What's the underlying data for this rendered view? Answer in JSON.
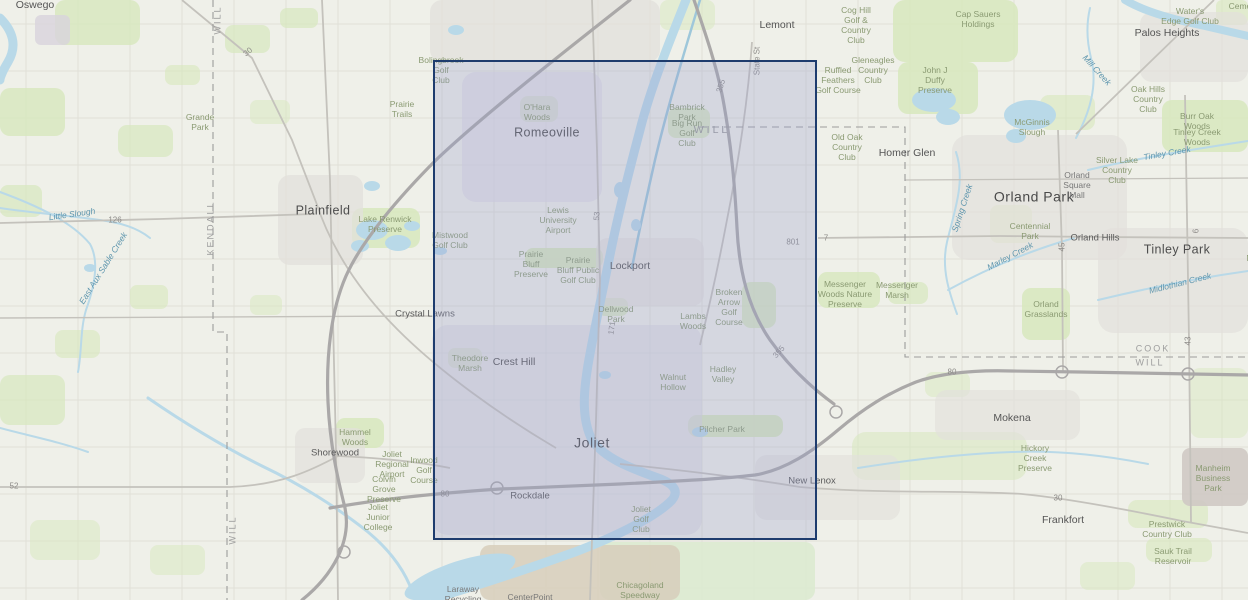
{
  "map": {
    "background": "#eff0e9",
    "selection": {
      "x": 433,
      "y": 60,
      "w": 384,
      "h": 480,
      "fill": "rgba(151,160,205,0.30)",
      "border_color": "#1e3c6e",
      "border_px": 2.5
    },
    "labels": [
      {
        "text": "Oswego",
        "x": 35,
        "y": 5,
        "cls": "town"
      },
      {
        "text": "Plainfield",
        "x": 323,
        "y": 211,
        "cls": "town-lg"
      },
      {
        "text": "Romeoville",
        "x": 547,
        "y": 133,
        "cls": "town-lg"
      },
      {
        "text": "Lemont",
        "x": 777,
        "y": 25,
        "cls": "town"
      },
      {
        "text": "Palos Heights",
        "x": 1167,
        "y": 33,
        "cls": "town"
      },
      {
        "text": "Homer Glen",
        "x": 907,
        "y": 153,
        "cls": "town"
      },
      {
        "text": "Orland Park",
        "x": 1034,
        "y": 197,
        "cls": "town-xl"
      },
      {
        "text": "Orland Hills",
        "x": 1095,
        "y": 238,
        "cls": "town-sm"
      },
      {
        "text": "Tinley Park",
        "x": 1177,
        "y": 250,
        "cls": "town-lg"
      },
      {
        "text": "Lockport",
        "x": 630,
        "y": 266,
        "cls": "town"
      },
      {
        "text": "Crystal Lawns",
        "x": 425,
        "y": 314,
        "cls": "town-sm"
      },
      {
        "text": "Crest Hill",
        "x": 514,
        "y": 362,
        "cls": "town"
      },
      {
        "text": "Joliet",
        "x": 592,
        "y": 443,
        "cls": "town-xl"
      },
      {
        "text": "Rockdale",
        "x": 530,
        "y": 496,
        "cls": "town-sm"
      },
      {
        "text": "Shorewood",
        "x": 335,
        "y": 453,
        "cls": "town-sm"
      },
      {
        "text": "New Lenox",
        "x": 812,
        "y": 481,
        "cls": "town-sm"
      },
      {
        "text": "Mokena",
        "x": 1012,
        "y": 418,
        "cls": "town"
      },
      {
        "text": "Frankfort",
        "x": 1063,
        "y": 520,
        "cls": "town"
      },
      {
        "text": "Grande\nPark",
        "x": 200,
        "y": 122,
        "cls": "area"
      },
      {
        "text": "Prairie\nTrails",
        "x": 402,
        "y": 109,
        "cls": "area"
      },
      {
        "text": "Lake Renwick\nPreserve",
        "x": 385,
        "y": 224,
        "cls": "area"
      },
      {
        "text": "Bolingbrook\nGolf\nClub",
        "x": 441,
        "y": 70,
        "cls": "area"
      },
      {
        "text": "O'Hara\nWoods",
        "x": 537,
        "y": 112,
        "cls": "area"
      },
      {
        "text": "Bambrick\nPark",
        "x": 687,
        "y": 112,
        "cls": "area"
      },
      {
        "text": "Big Run\nGolf\nClub",
        "x": 687,
        "y": 133,
        "cls": "area"
      },
      {
        "text": "Mistwood\nGolf Club",
        "x": 450,
        "y": 240,
        "cls": "area"
      },
      {
        "text": "Lewis\nUniversity\nAirport",
        "x": 558,
        "y": 220,
        "cls": "area"
      },
      {
        "text": "Prairie\nBluff\nPreserve",
        "x": 531,
        "y": 264,
        "cls": "area"
      },
      {
        "text": "Prairie\nBluff Public\nGolf Club",
        "x": 578,
        "y": 270,
        "cls": "area"
      },
      {
        "text": "Dellwood\nPark",
        "x": 616,
        "y": 314,
        "cls": "area"
      },
      {
        "text": "Lambs\nWoods",
        "x": 693,
        "y": 321,
        "cls": "area"
      },
      {
        "text": "Broken\nArrow\nGolf\nCourse",
        "x": 729,
        "y": 307,
        "cls": "area"
      },
      {
        "text": "Theodore\nMarsh",
        "x": 470,
        "y": 363,
        "cls": "area"
      },
      {
        "text": "Walnut\nHollow",
        "x": 673,
        "y": 382,
        "cls": "area"
      },
      {
        "text": "Hadley\nValley",
        "x": 723,
        "y": 374,
        "cls": "area"
      },
      {
        "text": "Pilcher Park",
        "x": 722,
        "y": 429,
        "cls": "area"
      },
      {
        "text": "Joliet\nGolf\nClub",
        "x": 641,
        "y": 519,
        "cls": "area"
      },
      {
        "text": "Hammel\nWoods",
        "x": 355,
        "y": 437,
        "cls": "area"
      },
      {
        "text": "Joliet\nRegional\nAirport",
        "x": 392,
        "y": 464,
        "cls": "area"
      },
      {
        "text": "Colvin\nGrove\nPreserve",
        "x": 384,
        "y": 489,
        "cls": "area"
      },
      {
        "text": "Inwood\nGolf\nCourse",
        "x": 424,
        "y": 470,
        "cls": "area"
      },
      {
        "text": "Joliet\nJunior\nCollege",
        "x": 378,
        "y": 517,
        "cls": "area"
      },
      {
        "text": "Cog Hill\nGolf &\nCountry\nClub",
        "x": 856,
        "y": 25,
        "cls": "area"
      },
      {
        "text": "Cap Sauers\nHoldings",
        "x": 978,
        "y": 19,
        "cls": "area"
      },
      {
        "text": "Gleneagles\nCountry\nClub",
        "x": 873,
        "y": 70,
        "cls": "area"
      },
      {
        "text": "Ruffled\nFeathers\nGolf Course",
        "x": 838,
        "y": 80,
        "cls": "area"
      },
      {
        "text": "John J\nDuffy\nPreserve",
        "x": 935,
        "y": 80,
        "cls": "area"
      },
      {
        "text": "Water's\nEdge Golf Club",
        "x": 1190,
        "y": 16,
        "cls": "area"
      },
      {
        "text": "Cemetery",
        "x": 1247,
        "y": 6,
        "cls": "area"
      },
      {
        "text": "Oak Hills\nCountry\nClub",
        "x": 1148,
        "y": 99,
        "cls": "area"
      },
      {
        "text": "Burr Oak\nWoods",
        "x": 1197,
        "y": 121,
        "cls": "area"
      },
      {
        "text": "Tinley Creek\nWoods",
        "x": 1197,
        "y": 137,
        "cls": "area"
      },
      {
        "text": "McGinnis\nSlough",
        "x": 1032,
        "y": 127,
        "cls": "area"
      },
      {
        "text": "Old Oak\nCountry\nClub",
        "x": 847,
        "y": 147,
        "cls": "area"
      },
      {
        "text": "Silver Lake\nCountry\nClub",
        "x": 1117,
        "y": 170,
        "cls": "area"
      },
      {
        "text": "Orland\nSquare\nMall",
        "x": 1077,
        "y": 185,
        "cls": "poi-gray"
      },
      {
        "text": "Centennial\nPark",
        "x": 1030,
        "y": 231,
        "cls": "area"
      },
      {
        "text": "Messenger\nWoods Nature\nPreserve",
        "x": 845,
        "y": 294,
        "cls": "area"
      },
      {
        "text": "Messenger\nMarsh",
        "x": 897,
        "y": 290,
        "cls": "area"
      },
      {
        "text": "Orland\nGrasslands",
        "x": 1046,
        "y": 309,
        "cls": "area"
      },
      {
        "text": "Hickory\nCreek\nPreserve",
        "x": 1035,
        "y": 458,
        "cls": "area"
      },
      {
        "text": "Manheim\nBusiness\nPark",
        "x": 1213,
        "y": 478,
        "cls": "area"
      },
      {
        "text": "Prestwick\nCountry Club",
        "x": 1167,
        "y": 529,
        "cls": "area"
      },
      {
        "text": "Sauk Trail\nReservoir",
        "x": 1173,
        "y": 556,
        "cls": "area"
      },
      {
        "text": "Chicagoland\nSpeedway",
        "x": 640,
        "y": 590,
        "cls": "area"
      },
      {
        "text": "CenterPoint",
        "x": 530,
        "y": 597,
        "cls": "poi-gray"
      },
      {
        "text": "Laraway\nRecycling",
        "x": 463,
        "y": 594,
        "cls": "poi-gray"
      },
      {
        "text": "George W Dunne\nNational",
        "x": 1262,
        "y": 243,
        "cls": "area"
      },
      {
        "text": "Little Slough",
        "x": 72,
        "y": 214,
        "cls": "water",
        "rot": -8
      },
      {
        "text": "East Aux Sable Creek",
        "x": 103,
        "y": 268,
        "cls": "water",
        "rot": -58
      },
      {
        "text": "Mill Creek",
        "x": 1097,
        "y": 70,
        "cls": "water",
        "rot": 48
      },
      {
        "text": "Spring Creek",
        "x": 962,
        "y": 208,
        "cls": "water",
        "rot": -72
      },
      {
        "text": "Marley Creek",
        "x": 1010,
        "y": 256,
        "cls": "water",
        "rot": -28
      },
      {
        "text": "Midlothian Creek",
        "x": 1180,
        "y": 283,
        "cls": "water",
        "rot": -14
      },
      {
        "text": "Tinley Creek",
        "x": 1167,
        "y": 153,
        "cls": "water",
        "rot": -10
      },
      {
        "text": "WILL",
        "x": 218,
        "y": 20,
        "cls": "county",
        "rot": -90
      },
      {
        "text": "KENDALL",
        "x": 211,
        "y": 228,
        "cls": "county",
        "rot": -90
      },
      {
        "text": "WILL",
        "x": 233,
        "y": 530,
        "cls": "county",
        "rot": -90
      },
      {
        "text": "WILL",
        "x": 712,
        "y": 130,
        "cls": "county-lg"
      },
      {
        "text": "COOK",
        "x": 1153,
        "y": 349,
        "cls": "county"
      },
      {
        "text": "WILL",
        "x": 1150,
        "y": 363,
        "cls": "county"
      },
      {
        "text": "30",
        "x": 248,
        "y": 52,
        "cls": "road",
        "rot": -40
      },
      {
        "text": "126",
        "x": 115,
        "y": 220,
        "cls": "road"
      },
      {
        "text": "52",
        "x": 14,
        "y": 486,
        "cls": "road"
      },
      {
        "text": "53",
        "x": 597,
        "y": 216,
        "cls": "road",
        "rot": -85
      },
      {
        "text": "State St",
        "x": 757,
        "y": 61,
        "cls": "road",
        "rot": -90
      },
      {
        "text": "355",
        "x": 721,
        "y": 86,
        "cls": "road",
        "rot": -72
      },
      {
        "text": "355",
        "x": 779,
        "y": 352,
        "cls": "road",
        "rot": -48
      },
      {
        "text": "171",
        "x": 612,
        "y": 328,
        "cls": "road",
        "rot": -82
      },
      {
        "text": "801",
        "x": 793,
        "y": 242,
        "cls": "road"
      },
      {
        "text": "7",
        "x": 826,
        "y": 238,
        "cls": "road"
      },
      {
        "text": "80",
        "x": 445,
        "y": 494,
        "cls": "road"
      },
      {
        "text": "80",
        "x": 952,
        "y": 372,
        "cls": "road"
      },
      {
        "text": "30",
        "x": 1058,
        "y": 498,
        "cls": "road"
      },
      {
        "text": "45",
        "x": 1062,
        "y": 247,
        "cls": "road",
        "rot": -90
      },
      {
        "text": "6",
        "x": 1196,
        "y": 231,
        "cls": "road",
        "rot": -90
      },
      {
        "text": "43",
        "x": 1188,
        "y": 341,
        "cls": "road",
        "rot": -90
      }
    ]
  }
}
